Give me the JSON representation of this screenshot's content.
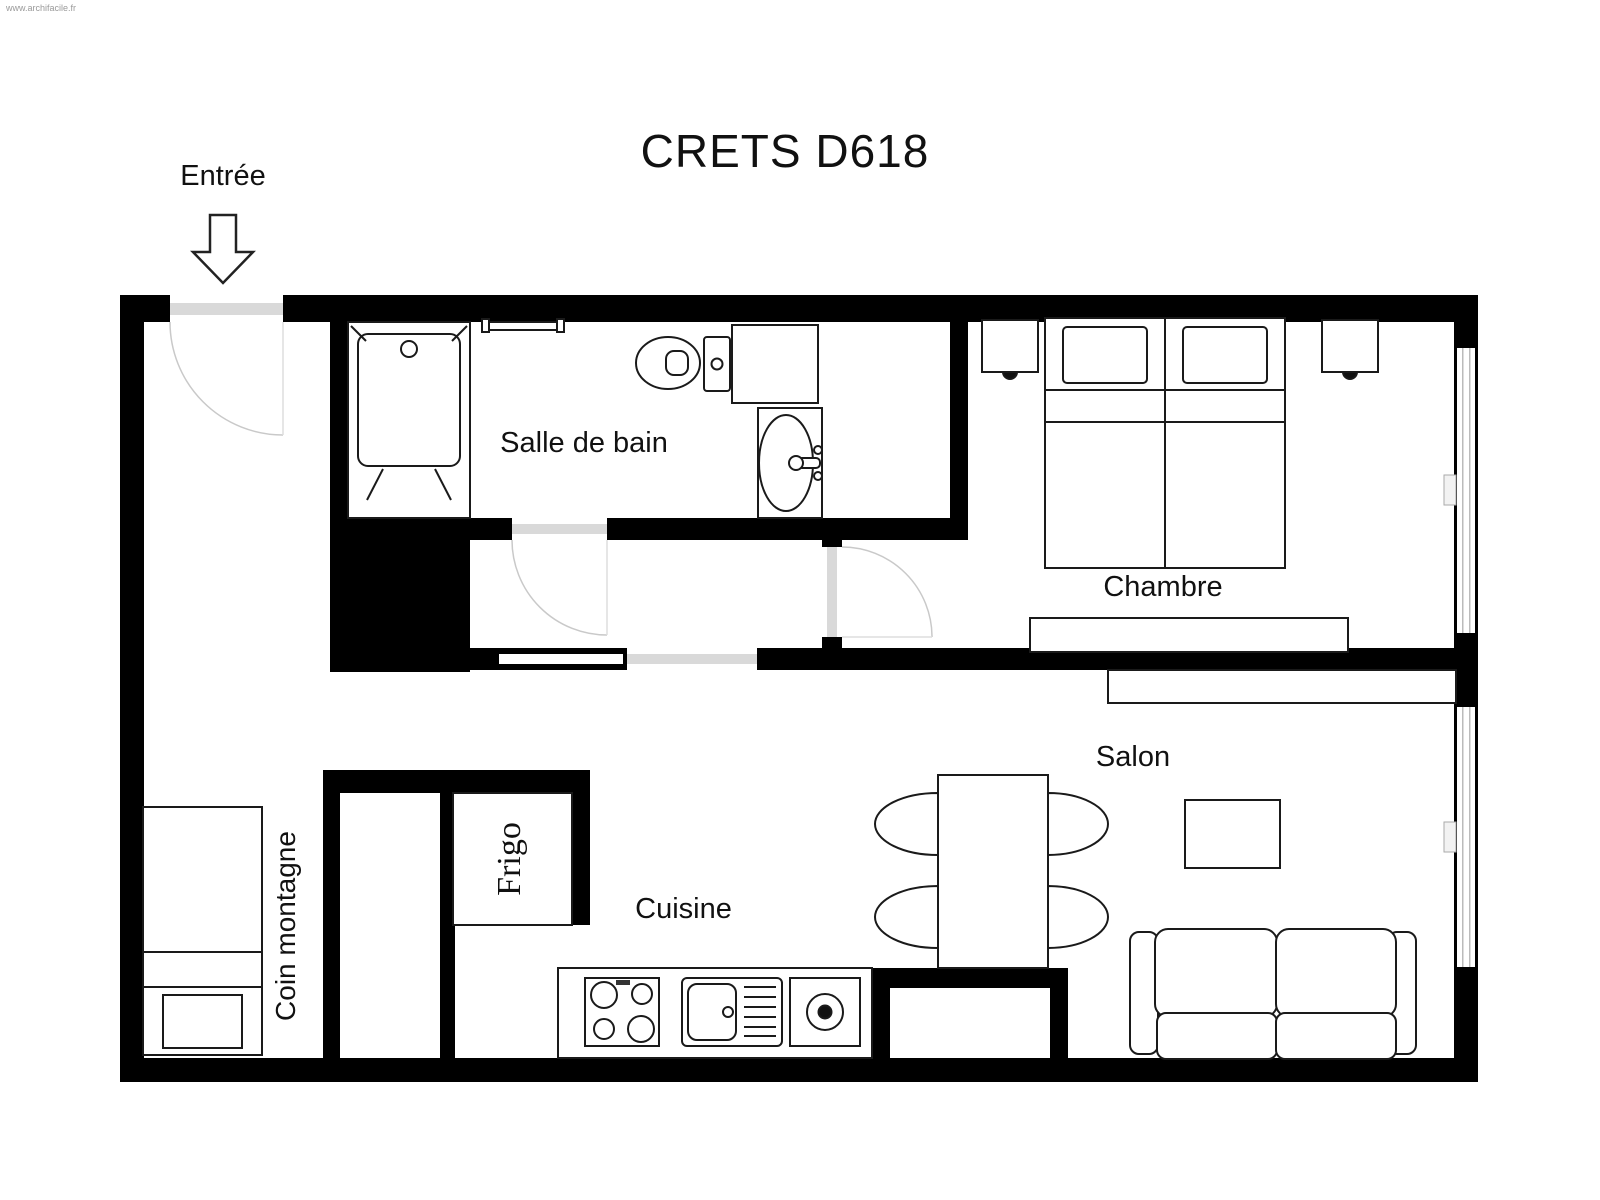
{
  "watermark": "www.archifacile.fr",
  "title": "CRETS D618",
  "labels": {
    "entrance": "Entrée",
    "bathroom": "Salle de bain",
    "bedroom": "Chambre",
    "living_room": "Salon",
    "kitchen": "Cuisine",
    "mountain_corner": "Coin montagne",
    "fridge": "Frigo"
  },
  "colors": {
    "walls": "#000000",
    "background": "#ffffff",
    "furniture_line": "#1a1a1a",
    "door_threshold": "#d9d9d9",
    "door_arc": "#c9c9c9",
    "watermark_text": "#9a9a9a"
  },
  "rooms": [
    {
      "name": "Entrée",
      "fixtures": [
        "entry-arrow",
        "entry-door"
      ]
    },
    {
      "name": "Salle de bain",
      "fixtures": [
        "bathtub",
        "towel-rail",
        "toilet",
        "toilet-cabinet",
        "washbasin",
        "door"
      ]
    },
    {
      "name": "Chambre",
      "fixtures": [
        "nightstand-left",
        "twin-beds",
        "pillows",
        "nightstand-right",
        "dresser",
        "door",
        "window"
      ]
    },
    {
      "name": "Salon",
      "fixtures": [
        "wall-shelf",
        "dining-table",
        "chair",
        "chair",
        "chair",
        "chair",
        "coffee-table",
        "sofa",
        "window"
      ]
    },
    {
      "name": "Cuisine",
      "fixtures": [
        "fridge",
        "counter",
        "stove",
        "kitchen-sink",
        "hotplate"
      ]
    },
    {
      "name": "Coin montagne",
      "fixtures": [
        "bed",
        "side-table",
        "closet"
      ]
    }
  ]
}
